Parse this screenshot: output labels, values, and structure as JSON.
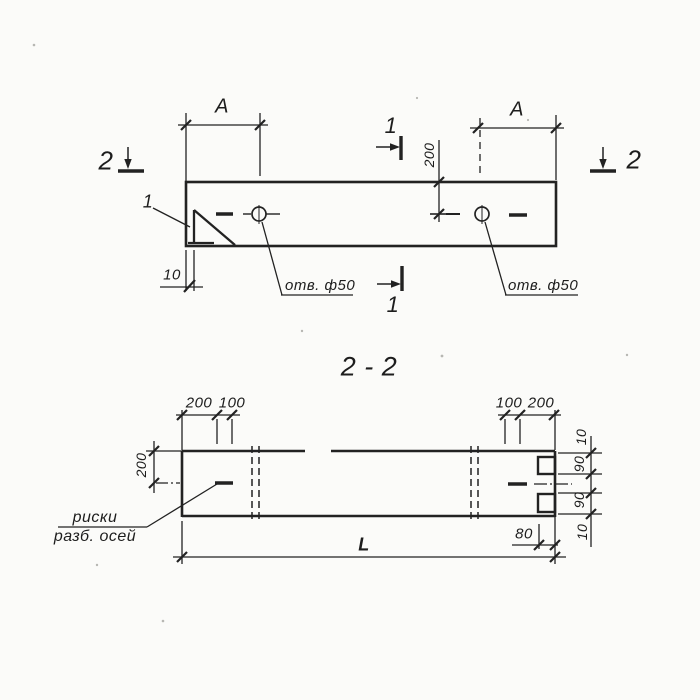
{
  "colors": {
    "paper": "#fbfbf9",
    "ink": "#222222"
  },
  "plan_view": {
    "span_dim_left": "A",
    "span_dim_right": "A",
    "section_mark_2_left": "2",
    "section_mark_2_right": "2",
    "section_mark_1_top": "1",
    "section_mark_1_bottom": "1",
    "detail_callout": "1",
    "edge_to_hole_dim": "200",
    "corner_offset_dim": "10",
    "hole_label_left": "отв. ф50",
    "hole_label_right": "отв. ф50"
  },
  "section_view": {
    "title": "2 - 2",
    "top_left_dims": [
      "200",
      "100"
    ],
    "top_right_dims": [
      "100",
      "200"
    ],
    "height_dim": "200",
    "right_chain_dims": [
      "10",
      "90",
      "90",
      "10"
    ],
    "notch_depth_dim": "80",
    "length_dim": "L",
    "axis_note_line1": "риски",
    "axis_note_line2": "разб. осей"
  }
}
